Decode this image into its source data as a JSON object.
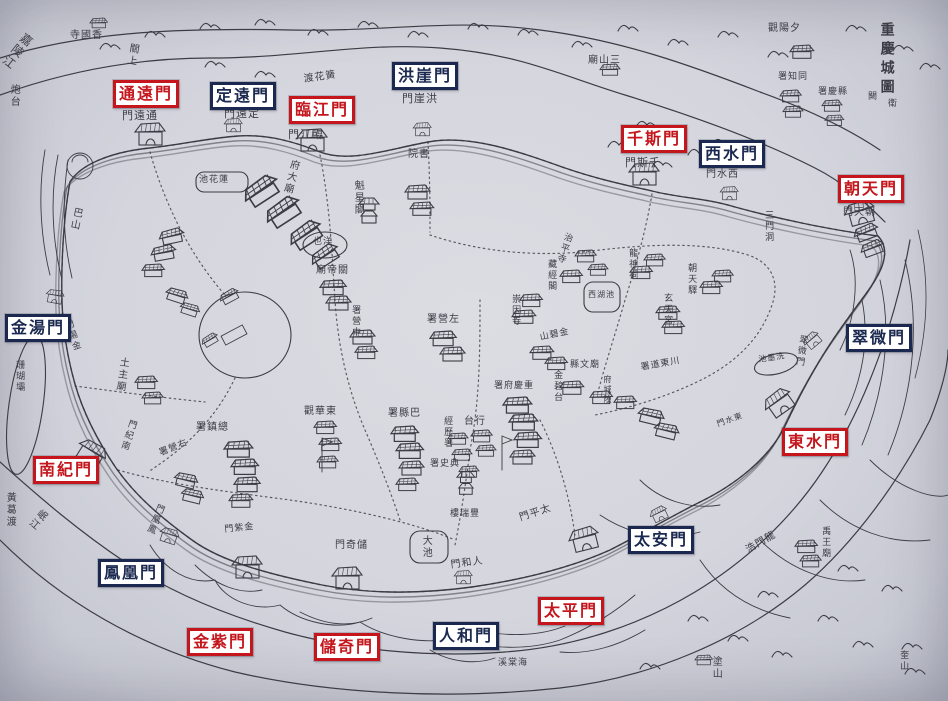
{
  "map": {
    "title": "重慶城圖",
    "region_labels": {
      "top_left_river": "嘉陵江",
      "bottom_left_river": "岷江"
    }
  },
  "colors": {
    "open_gate_red": "#c4161c",
    "closed_gate_navy": "#1b2950",
    "paper": "#d4d5dd",
    "ink": "#3b3c44"
  },
  "gates": [
    {
      "name": "通遠門",
      "type": "open",
      "x": 113,
      "y": 80
    },
    {
      "name": "定遠門",
      "type": "closed",
      "x": 210,
      "y": 82
    },
    {
      "name": "臨江門",
      "type": "open",
      "x": 289,
      "y": 96
    },
    {
      "name": "洪崖門",
      "type": "closed",
      "x": 392,
      "y": 62
    },
    {
      "name": "千斯門",
      "type": "open",
      "x": 621,
      "y": 125
    },
    {
      "name": "西水門",
      "type": "closed",
      "x": 699,
      "y": 140
    },
    {
      "name": "朝天門",
      "type": "open",
      "x": 838,
      "y": 175
    },
    {
      "name": "金湯門",
      "type": "closed",
      "x": 5,
      "y": 314
    },
    {
      "name": "翠微門",
      "type": "closed",
      "x": 846,
      "y": 324
    },
    {
      "name": "東水門",
      "type": "open",
      "x": 782,
      "y": 428
    },
    {
      "name": "南紀門",
      "type": "open",
      "x": 33,
      "y": 456
    },
    {
      "name": "太安門",
      "type": "closed",
      "x": 628,
      "y": 526
    },
    {
      "name": "鳳凰門",
      "type": "closed",
      "x": 98,
      "y": 559
    },
    {
      "name": "太平門",
      "type": "open",
      "x": 538,
      "y": 597
    },
    {
      "name": "金紫門",
      "type": "open",
      "x": 187,
      "y": 628
    },
    {
      "name": "儲奇門",
      "type": "open",
      "x": 314,
      "y": 633
    },
    {
      "name": "人和門",
      "type": "closed",
      "x": 433,
      "y": 622
    }
  ],
  "place_names": [
    [
      "嘉陵江",
      24,
      30,
      "v",
      38,
      12,
      ""
    ],
    [
      "寺國香",
      70,
      30,
      "h",
      0,
      10,
      ""
    ],
    [
      "關上",
      128,
      42,
      "v",
      10,
      10,
      ""
    ],
    [
      "炮台",
      8,
      84,
      "v",
      0,
      10,
      ""
    ],
    [
      "門遠通",
      122,
      110,
      "h",
      0,
      11,
      ""
    ],
    [
      "門遠定",
      224,
      108,
      "h",
      0,
      11,
      ""
    ],
    [
      "渡花簧",
      303,
      74,
      "h",
      -8,
      10,
      ""
    ],
    [
      "門江臨",
      288,
      129,
      "h",
      0,
      11,
      ""
    ],
    [
      "門崖洪",
      402,
      93,
      "h",
      0,
      11,
      ""
    ],
    [
      "廟山三",
      588,
      55,
      "h",
      0,
      10,
      ""
    ],
    [
      "觀陽夕",
      768,
      23,
      "h",
      0,
      10,
      ""
    ],
    [
      "署知同",
      778,
      72,
      "h",
      0,
      9,
      ""
    ],
    [
      "署慶縣",
      818,
      87,
      "h",
      0,
      9,
      ""
    ],
    [
      "重慶城圖",
      878,
      22,
      "v",
      0,
      14,
      "title"
    ],
    [
      "闕",
      868,
      92,
      "h",
      0,
      9,
      ""
    ],
    [
      "衛",
      888,
      99,
      "h",
      0,
      9,
      ""
    ],
    [
      "門天朝",
      843,
      207,
      "h",
      0,
      10,
      ""
    ],
    [
      "三門洞",
      763,
      210,
      "v",
      0,
      9,
      ""
    ],
    [
      "門斯千",
      625,
      157,
      "h",
      0,
      11,
      ""
    ],
    [
      "門水西",
      706,
      169,
      "h",
      0,
      10,
      ""
    ],
    [
      "院書",
      408,
      149,
      "h",
      0,
      10,
      ""
    ],
    [
      "魁星閣",
      352,
      180,
      "v",
      0,
      10,
      ""
    ],
    [
      "池花蓮",
      199,
      175,
      "h",
      0,
      9,
      ""
    ],
    [
      "府大廟",
      289,
      158,
      "v",
      14,
      10,
      ""
    ],
    [
      "也洋",
      313,
      237,
      "h",
      0,
      9,
      ""
    ],
    [
      "廟帝關",
      316,
      265,
      "h",
      0,
      10,
      ""
    ],
    [
      "署營中",
      350,
      305,
      "v",
      0,
      9,
      ""
    ],
    [
      "巴山",
      72,
      206,
      "v",
      12,
      10,
      ""
    ],
    [
      "珊瑚壩",
      14,
      360,
      "v",
      0,
      9,
      ""
    ],
    [
      "土主廟",
      118,
      356,
      "v",
      8,
      10,
      ""
    ],
    [
      "門湯金",
      62,
      322,
      "v",
      -18,
      9,
      ""
    ],
    [
      "門紀南",
      128,
      418,
      "v",
      18,
      9,
      ""
    ],
    [
      "署鎮總",
      196,
      422,
      "h",
      0,
      10,
      ""
    ],
    [
      "署營右",
      158,
      449,
      "h",
      -22,
      9,
      ""
    ],
    [
      "門凰鳳",
      156,
      502,
      "v",
      22,
      9,
      ""
    ],
    [
      "門紫金",
      224,
      525,
      "h",
      -6,
      9,
      ""
    ],
    [
      "門奇儲",
      335,
      540,
      "h",
      0,
      10,
      ""
    ],
    [
      "門和人",
      450,
      560,
      "h",
      -8,
      10,
      ""
    ],
    [
      "門平太",
      518,
      513,
      "h",
      -18,
      10,
      ""
    ],
    [
      "樓瑞豐",
      450,
      509,
      "h",
      0,
      9,
      ""
    ],
    [
      "觀華東",
      304,
      406,
      "h",
      0,
      10,
      ""
    ],
    [
      "署縣巴",
      388,
      408,
      "h",
      0,
      10,
      ""
    ],
    [
      "經歷署",
      442,
      416,
      "v",
      0,
      9,
      ""
    ],
    [
      "台行",
      464,
      416,
      "h",
      0,
      10,
      ""
    ],
    [
      "署史典",
      430,
      459,
      "h",
      0,
      9,
      ""
    ],
    [
      "署府慶重",
      494,
      381,
      "h",
      0,
      9,
      ""
    ],
    [
      "署營左",
      427,
      314,
      "h",
      0,
      10,
      ""
    ],
    [
      "山碧金",
      539,
      333,
      "h",
      -12,
      9,
      ""
    ],
    [
      "金碧台",
      552,
      370,
      "v",
      0,
      9,
      ""
    ],
    [
      "縣文廟",
      570,
      360,
      "h",
      0,
      9,
      ""
    ],
    [
      "府城隍",
      602,
      375,
      "v",
      0,
      8,
      ""
    ],
    [
      "署道東川",
      640,
      363,
      "h",
      -10,
      9,
      ""
    ],
    [
      "西湖池",
      588,
      291,
      "h",
      0,
      8,
      ""
    ],
    [
      "玄天宮",
      662,
      293,
      "v",
      0,
      9,
      ""
    ],
    [
      "龍神祠",
      627,
      248,
      "v",
      0,
      9,
      ""
    ],
    [
      "治平寺",
      564,
      231,
      "v",
      18,
      9,
      ""
    ],
    [
      "藏經閣",
      546,
      259,
      "v",
      0,
      9,
      ""
    ],
    [
      "崇因寺",
      510,
      294,
      "v",
      0,
      9,
      ""
    ],
    [
      "朝天驛",
      686,
      263,
      "v",
      0,
      9,
      ""
    ],
    [
      "池墨洗",
      758,
      356,
      "h",
      -8,
      8,
      ""
    ],
    [
      "翠微門",
      798,
      334,
      "v",
      8,
      9,
      ""
    ],
    [
      "門水東",
      716,
      421,
      "h",
      -20,
      8,
      ""
    ],
    [
      "禹王廟",
      820,
      526,
      "v",
      0,
      9,
      ""
    ],
    [
      "浩門龍",
      744,
      546,
      "h",
      -30,
      10,
      ""
    ],
    [
      "溪棠海",
      498,
      658,
      "h",
      0,
      9,
      ""
    ],
    [
      "塗山",
      710,
      656,
      "v",
      0,
      10,
      ""
    ],
    [
      "黃葛渡",
      4,
      492,
      "v",
      0,
      10,
      ""
    ],
    [
      "岷江",
      40,
      506,
      "v",
      40,
      10,
      ""
    ],
    [
      "奎山",
      898,
      650,
      "v",
      0,
      9,
      ""
    ],
    [
      "大池",
      420,
      535,
      "v",
      0,
      10,
      ""
    ]
  ],
  "map_features": {
    "gate_towers": [
      [
        138,
        132,
        0,
        1
      ],
      [
        300,
        138,
        0,
        1
      ],
      [
        632,
        172,
        0,
        1
      ],
      [
        848,
        214,
        -15,
        1
      ],
      [
        768,
        408,
        -35,
        1
      ],
      [
        82,
        445,
        32,
        1
      ],
      [
        235,
        565,
        0,
        1
      ],
      [
        335,
        576,
        0,
        1
      ],
      [
        572,
        540,
        -14,
        1
      ],
      [
        226,
        124,
        0,
        0.6
      ],
      [
        415,
        128,
        0,
        0.6
      ],
      [
        722,
        192,
        0,
        0.6
      ],
      [
        48,
        294,
        10,
        0.6
      ],
      [
        806,
        344,
        -40,
        0.6
      ],
      [
        456,
        576,
        0,
        0.6
      ],
      [
        652,
        516,
        -25,
        0.6
      ],
      [
        162,
        532,
        18,
        0.65
      ]
    ],
    "buildings": [
      [
        90,
        18,
        0,
        0.7
      ],
      [
        600,
        64,
        0,
        0.8
      ],
      [
        790,
        45,
        0,
        0.95
      ],
      [
        780,
        90,
        0,
        0.85
      ],
      [
        783,
        106,
        0,
        0.8
      ],
      [
        822,
        100,
        0,
        0.8
      ],
      [
        825,
        115,
        0,
        0.75
      ],
      [
        405,
        185,
        0,
        1
      ],
      [
        410,
        202,
        0,
        0.95
      ],
      [
        240,
        192,
        -33,
        1.5
      ],
      [
        262,
        213,
        -33,
        1.5
      ],
      [
        286,
        236,
        -33,
        1.4
      ],
      [
        308,
        257,
        -33,
        1.2
      ],
      [
        320,
        280,
        0,
        1.05
      ],
      [
        326,
        296,
        0,
        1
      ],
      [
        350,
        330,
        0,
        1
      ],
      [
        355,
        346,
        0,
        0.9
      ],
      [
        158,
        232,
        -12,
        1
      ],
      [
        150,
        248,
        -10,
        1
      ],
      [
        142,
        264,
        0,
        0.9
      ],
      [
        168,
        286,
        18,
        0.9
      ],
      [
        182,
        301,
        18,
        0.8
      ],
      [
        135,
        376,
        0,
        0.9
      ],
      [
        142,
        392,
        0,
        0.85
      ],
      [
        430,
        331,
        0,
        1.05
      ],
      [
        440,
        347,
        0,
        1
      ],
      [
        512,
        310,
        0,
        0.95
      ],
      [
        520,
        294,
        0,
        0.9
      ],
      [
        560,
        270,
        0,
        0.9
      ],
      [
        575,
        250,
        0,
        0.85
      ],
      [
        588,
        264,
        0,
        0.8
      ],
      [
        630,
        266,
        0,
        0.9
      ],
      [
        644,
        254,
        0,
        0.85
      ],
      [
        656,
        306,
        0,
        0.95
      ],
      [
        662,
        321,
        0,
        0.9
      ],
      [
        700,
        281,
        0,
        0.9
      ],
      [
        712,
        270,
        0,
        0.85
      ],
      [
        852,
        230,
        -20,
        1
      ],
      [
        859,
        246,
        -20,
        0.95
      ],
      [
        530,
        346,
        0,
        0.95
      ],
      [
        545,
        357,
        0,
        0.9
      ],
      [
        560,
        381,
        0,
        0.95
      ],
      [
        590,
        391,
        0,
        0.9
      ],
      [
        614,
        396,
        0,
        0.9
      ],
      [
        640,
        406,
        14,
        1.05
      ],
      [
        656,
        421,
        14,
        1
      ],
      [
        503,
        397,
        0,
        1.15
      ],
      [
        509,
        414,
        0,
        1.15
      ],
      [
        514,
        432,
        0,
        1.1
      ],
      [
        510,
        450,
        0,
        1
      ],
      [
        391,
        426,
        0,
        1.1
      ],
      [
        396,
        443,
        0,
        1.1
      ],
      [
        399,
        461,
        0,
        1
      ],
      [
        396,
        478,
        0,
        0.9
      ],
      [
        448,
        433,
        0,
        0.8
      ],
      [
        452,
        449,
        0,
        0.8
      ],
      [
        459,
        466,
        0,
        0.8
      ],
      [
        471,
        430,
        0,
        0.85
      ],
      [
        476,
        445,
        0,
        0.8
      ],
      [
        314,
        421,
        0,
        0.9
      ],
      [
        319,
        438,
        0,
        0.9
      ],
      [
        317,
        456,
        0,
        0.85
      ],
      [
        224,
        441,
        0,
        1.15
      ],
      [
        231,
        459,
        0,
        1.1
      ],
      [
        234,
        477,
        0,
        1.05
      ],
      [
        229,
        494,
        0,
        0.95
      ],
      [
        176,
        471,
        14,
        0.95
      ],
      [
        183,
        487,
        14,
        0.9
      ],
      [
        200,
        340,
        -30,
        0.7
      ],
      [
        218,
        296,
        -28,
        0.8
      ],
      [
        795,
        540,
        0,
        0.9
      ],
      [
        800,
        555,
        0,
        0.85
      ],
      [
        695,
        655,
        0,
        0.7
      ]
    ],
    "towers": [
      [
        358,
        196,
        0,
        1
      ],
      [
        456,
        470,
        0,
        0.9
      ]
    ],
    "mountains": [
      [
        145,
        28
      ],
      [
        200,
        20
      ],
      [
        255,
        16
      ],
      [
        308,
        26
      ],
      [
        358,
        18
      ],
      [
        408,
        28
      ],
      [
        468,
        20
      ],
      [
        518,
        26
      ],
      [
        572,
        38
      ],
      [
        618,
        22
      ],
      [
        668,
        36
      ],
      [
        718,
        28
      ],
      [
        768,
        48
      ],
      [
        846,
        22
      ],
      [
        893,
        42
      ],
      [
        920,
        60
      ],
      [
        608,
        138
      ],
      [
        636,
        118
      ],
      [
        662,
        132
      ],
      [
        688,
        146
      ],
      [
        712,
        136
      ],
      [
        730,
        152
      ],
      [
        652,
        158
      ],
      [
        205,
        58
      ],
      [
        255,
        68
      ],
      [
        100,
        40
      ],
      [
        688,
        612
      ],
      [
        728,
        632
      ],
      [
        772,
        648
      ],
      [
        818,
        612
      ],
      [
        853,
        638
      ],
      [
        882,
        582
      ],
      [
        902,
        640
      ],
      [
        758,
        588
      ],
      [
        838,
        562
      ],
      [
        905,
        665
      ],
      [
        640,
        660
      ]
    ]
  }
}
